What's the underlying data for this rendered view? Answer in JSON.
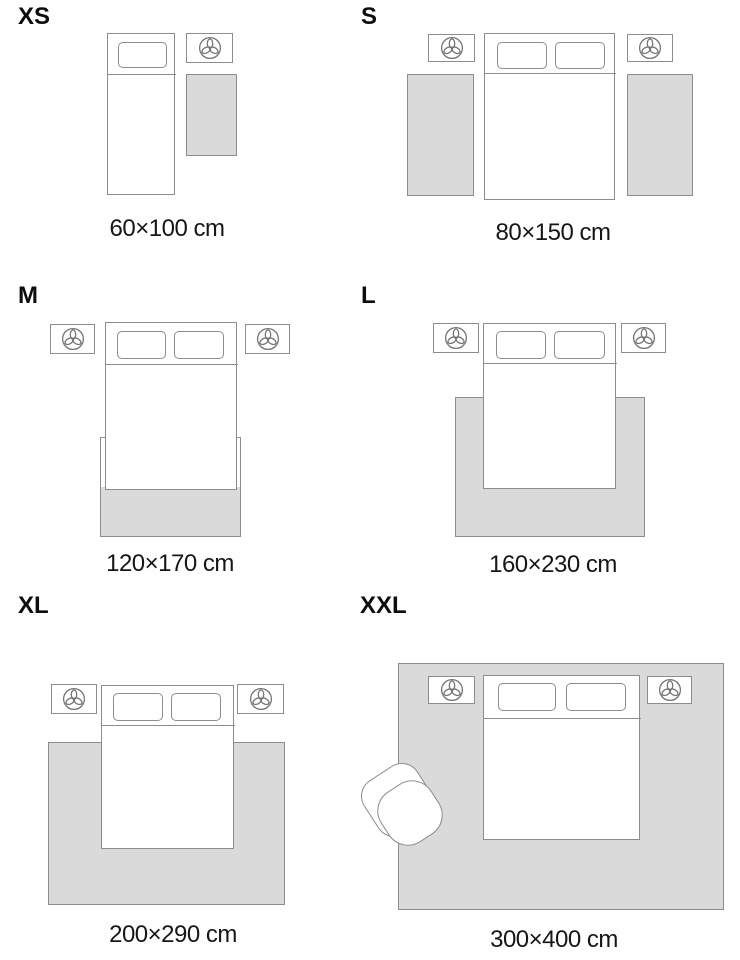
{
  "colors": {
    "rug_fill": "#dadada",
    "line": "#8d8d8d",
    "icon_line": "#757575",
    "text": "#161616"
  },
  "icons": {
    "nightstand_decor": "plant-icon"
  },
  "sizes": [
    {
      "id": "xs",
      "label": "XS",
      "dimensions": "60×100 cm"
    },
    {
      "id": "s",
      "label": "S",
      "dimensions": "80×150 cm"
    },
    {
      "id": "m",
      "label": "M",
      "dimensions": "120×170 cm"
    },
    {
      "id": "l",
      "label": "L",
      "dimensions": "160×230 cm"
    },
    {
      "id": "xl",
      "label": "XL",
      "dimensions": "200×290 cm"
    },
    {
      "id": "xxl",
      "label": "XXL",
      "dimensions": "300×400 cm"
    }
  ]
}
